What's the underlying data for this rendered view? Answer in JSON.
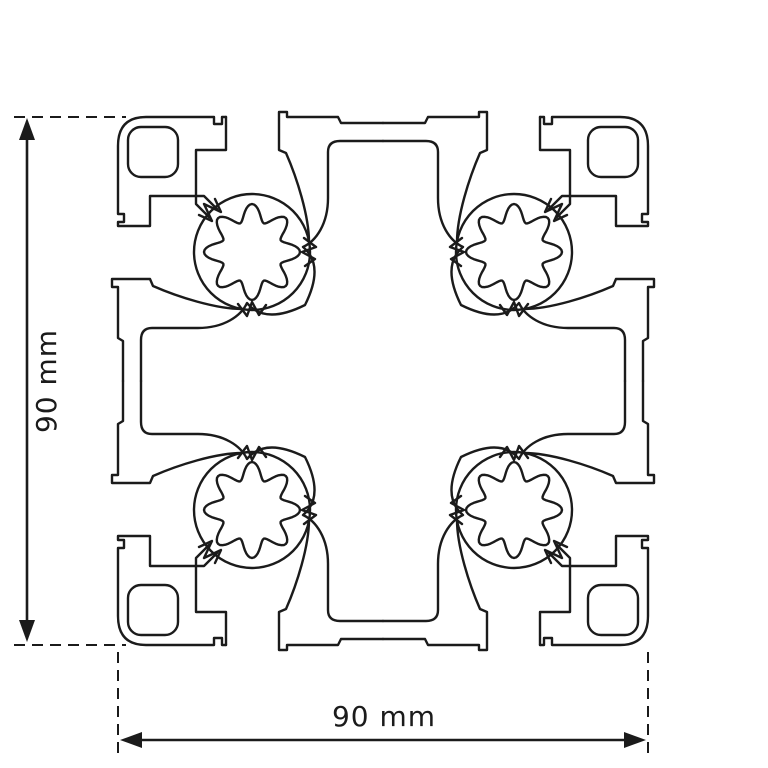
{
  "drawing": {
    "kind": "profile-cross-section"
  },
  "dimensions": {
    "width": {
      "label": "90 mm"
    },
    "height": {
      "label": "90 mm"
    }
  },
  "style": {
    "line_color": "#1b1b1b",
    "background_color": "#ffffff"
  }
}
